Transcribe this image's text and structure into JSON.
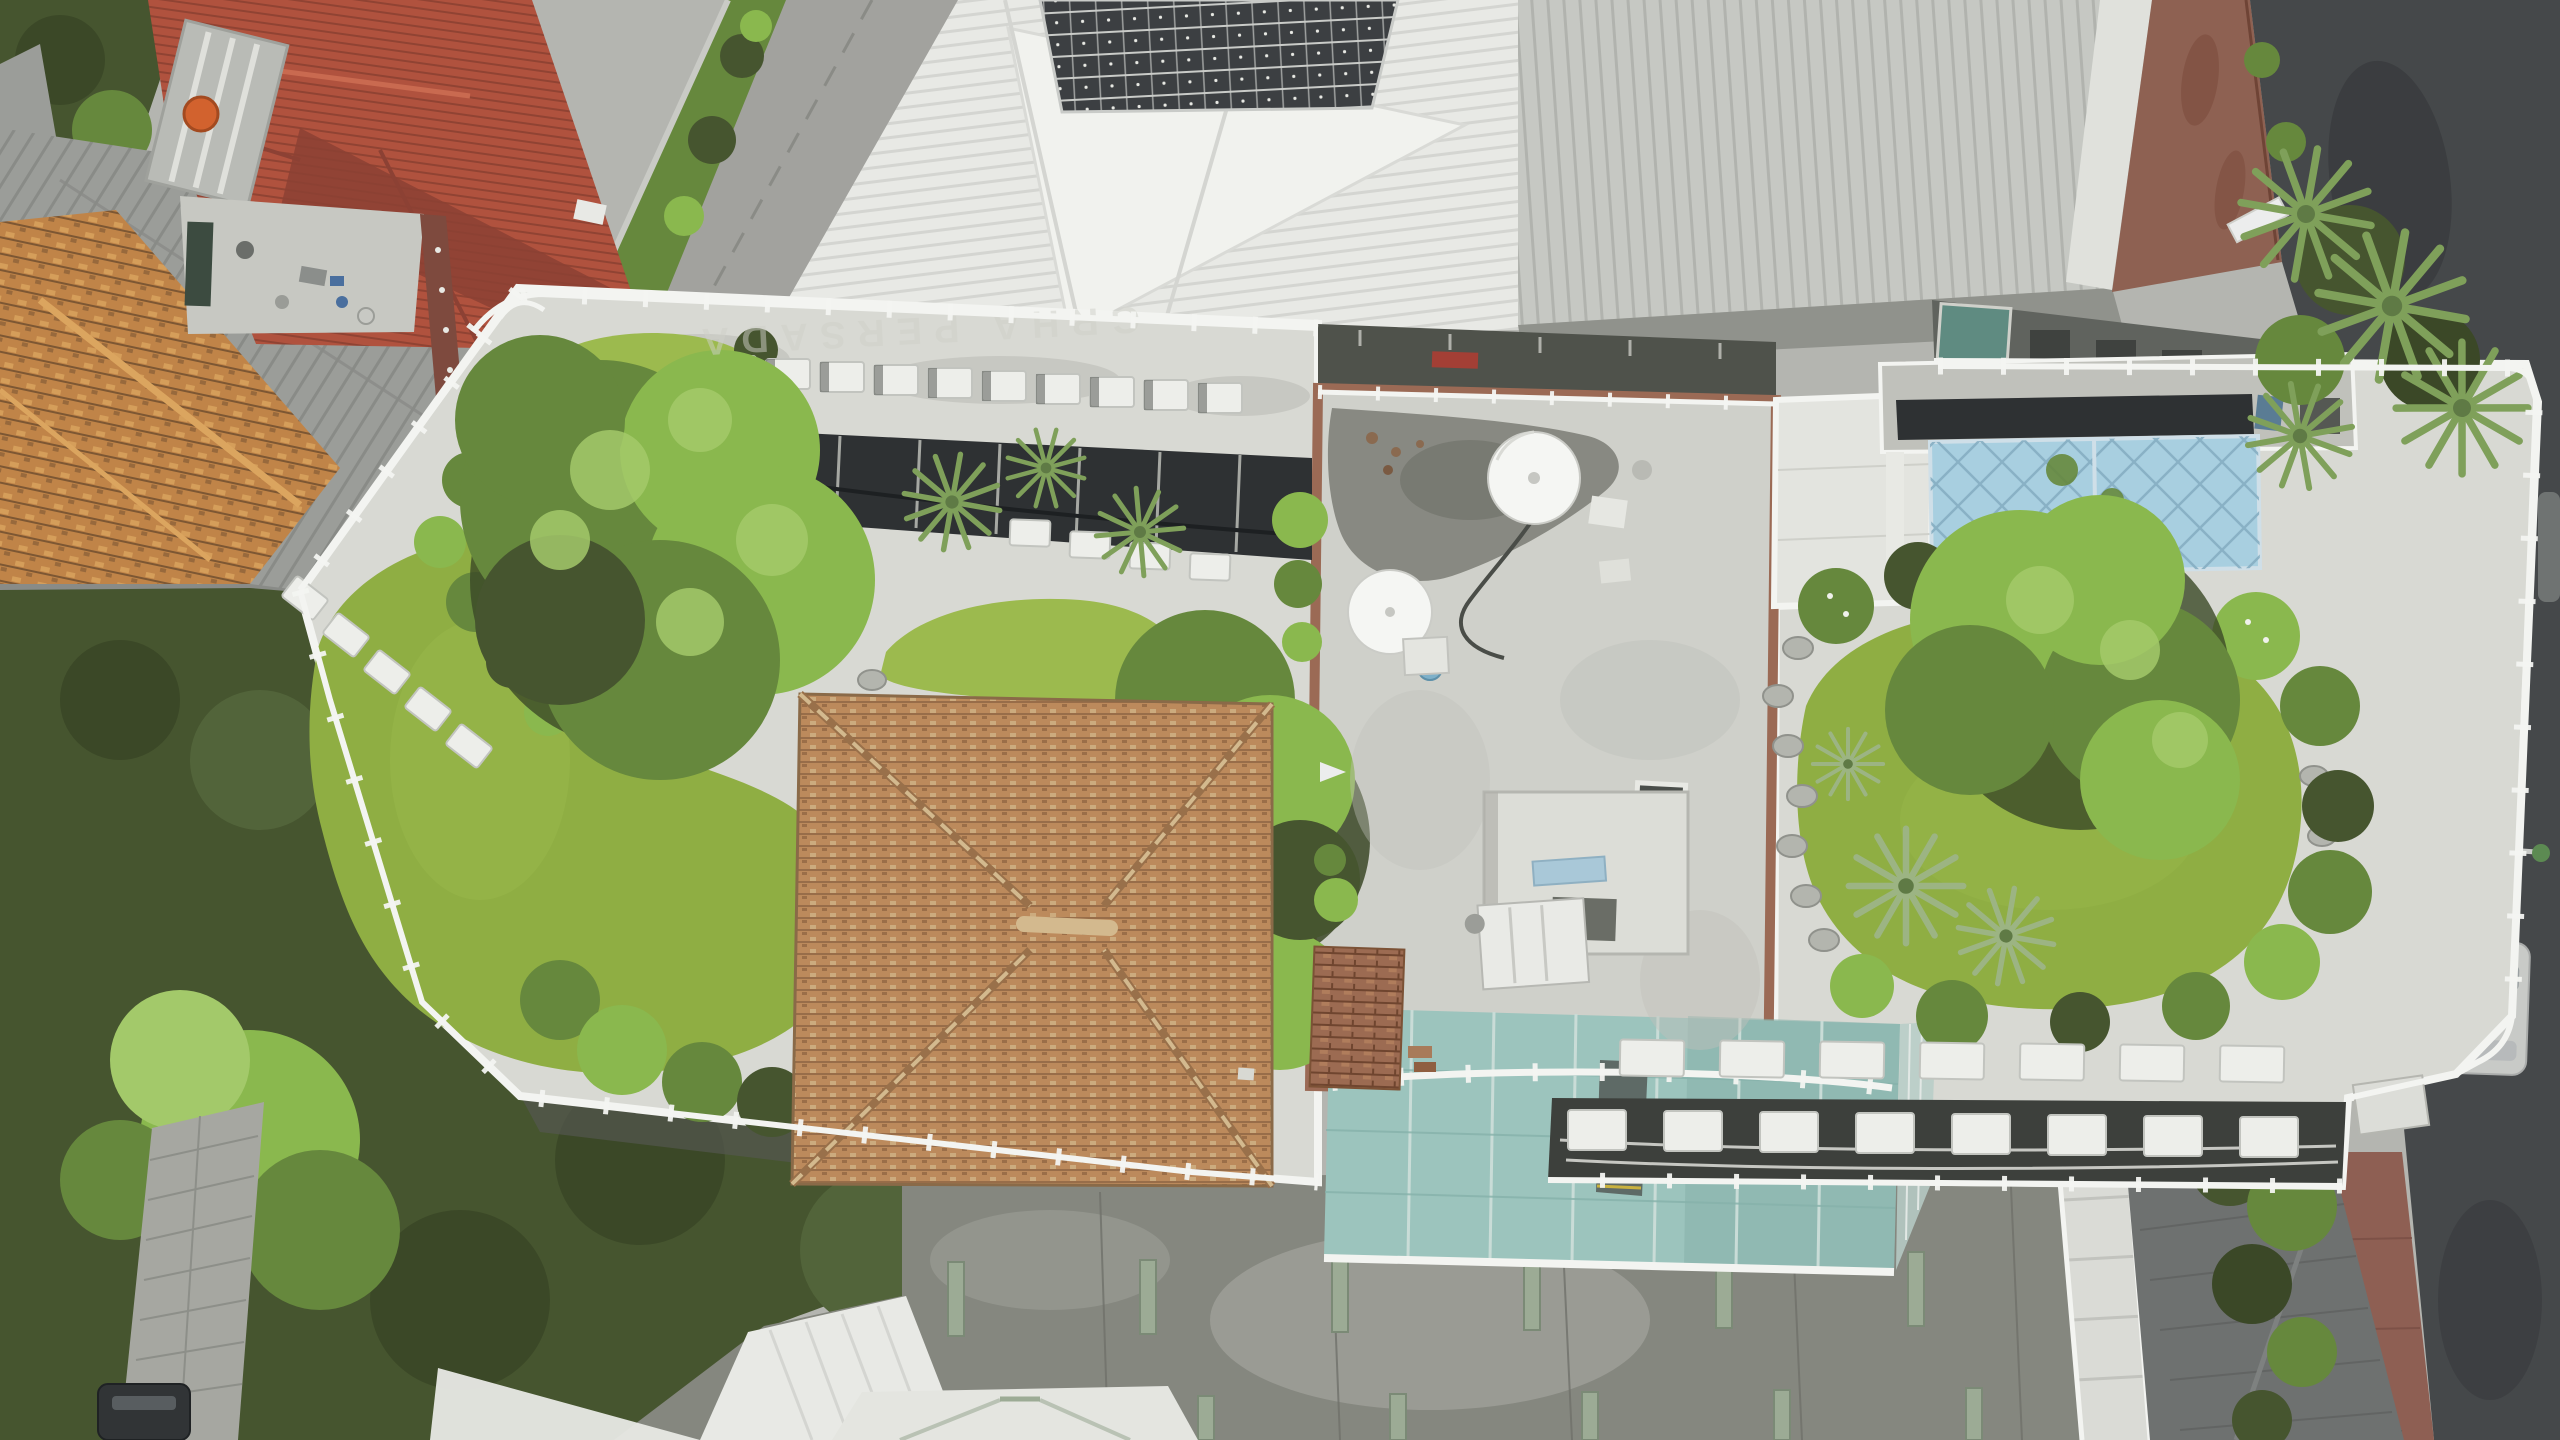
{
  "meta": {
    "title": "Aerial drone photograph, top-down view of an urban rooftop garden complex",
    "type": "aerial-photograph",
    "location_hint": "dense tropical city block"
  },
  "signage": {
    "parapet_text": "GRHA PERSADA"
  },
  "palette": {
    "bg": "#b4b5b0",
    "street_top": "#a2a29e",
    "street_asphalt": "#45484a",
    "street_wet": "#383b3d",
    "sidewalk_rust": "#8e6152",
    "sidewalk_red": "#8e5f53",
    "paver": "#a6a7a1",
    "paver_line": "#8d8f89",
    "veg_dark": "#46552f",
    "veg_dark2": "#3b4827",
    "veg_mid": "#66883d",
    "veg_bright": "#8ab84e",
    "veg_light": "#a3c96a",
    "palm_green": "#7fa05a",
    "palm_pale": "#9cb483",
    "lawn": "#8fae43",
    "lawn_light": "#9cba4e",
    "roof_white": "#e8e9e5",
    "roof_white_rib": "#d4d5d1",
    "roof_gray": "#c6c8c3",
    "roof_gray_rib": "#b1b3ae",
    "roof_gray_left": "#9b9d99",
    "roof_gray_left_dark": "#898b87",
    "solar": "#3c3f42",
    "solar_line": "#c9cbc8",
    "roof_red": "#b0523e",
    "roof_red_dark": "#8c4134",
    "clay": "#c08448",
    "clay_light": "#dba55f",
    "clay_dark": "#7d5733",
    "terrace": "#c7c8c2",
    "tank_orange": "#d2622e",
    "concrete": "#d8d9d3",
    "concrete_mottle": "#c0c1bb",
    "old_roof": "#cfd0ca",
    "wet_patch": "#84857d",
    "brick": "#9b6a55",
    "dish": "#f5f6f3",
    "teal": "#9cc4bd",
    "teal_dark": "#86b1aa",
    "teal_line": "#c9dcd7",
    "railing": "#f3f4f1",
    "ac": "#edeeea",
    "ac_dark": "#c2c4bf",
    "shade": "#2e3133",
    "deck": "#85877f",
    "deck_light": "#a8a9a2",
    "deck_line": "#6f716a",
    "beam": "#9cab95",
    "beam_dark": "#7b8a76",
    "tile_dark_roof": "#6e7170",
    "tile_dark_line": "#5c5f5e",
    "glassrail": "#b7cdc7",
    "water_blue": "#a8cfe0",
    "water_blue_line": "#86aec2",
    "car_red": "#a8403f",
    "car_silver": "#c8cac7",
    "car_dark": "#313436",
    "white_soft": "#e4e5e0",
    "shadow": "#545750",
    "banner": "#eceded",
    "bollard": "#c9a23f",
    "hip_base": "#bc8a5c",
    "hip_dark": "#8f6544",
    "hip_ridge": "#d3b98e"
  },
  "scene": {
    "regions": [
      {
        "name": "red-roof-house",
        "desc": "red clay-tile hip roof house, top-left, with gray metal skylight section",
        "color": "roof_red"
      },
      {
        "name": "orange-water-tank",
        "desc": "round orange water tank on red house roof",
        "color": "tank_orange"
      },
      {
        "name": "house-terrace",
        "desc": "cluttered gray service terrace of red house",
        "color": "terrace"
      },
      {
        "name": "clay-tile-roof",
        "desc": "weathered orange clay tile roof, lower left",
        "color": "clay"
      },
      {
        "name": "gray-metal-roofs-left",
        "desc": "old gray corrugated roofs along left edge",
        "color": "roof_gray_left"
      },
      {
        "name": "access-street-top",
        "desc": "concrete side street running diagonally at top with motorcycle and red car",
        "color": "street_top"
      },
      {
        "name": "white-metal-roofs",
        "desc": "white corrugated roofs, top center",
        "color": "roof_white"
      },
      {
        "name": "solar-panel-array",
        "desc": "dark rooftop solar panel array, top center-right",
        "color": "solar"
      },
      {
        "name": "warehouse-roof",
        "desc": "large pale gray ribbed warehouse roof, top right",
        "color": "roof_gray"
      },
      {
        "name": "rust-walkway",
        "desc": "rust stained walkway strip beside warehouse",
        "color": "sidewalk_rust"
      },
      {
        "name": "asphalt-street-right",
        "desc": "dark asphalt street along right edge with lamp, banner, cars",
        "color": "street_asphalt"
      },
      {
        "name": "rooftop-garden-left",
        "desc": "main rooftop garden, west wing: lawns, large trees, putting greens",
        "color": "concrete"
      },
      {
        "name": "main-lawn",
        "desc": "large organic artificial lawn, west wing",
        "color": "lawn"
      },
      {
        "name": "upper-putting-green",
        "desc": "small oval green below north railing",
        "color": "lawn_light"
      },
      {
        "name": "middle-putting-green",
        "desc": "kidney shaped green under fan palms",
        "color": "lawn_light"
      },
      {
        "name": "large-garden-tree",
        "desc": "large bright tree canopy over west lawn",
        "color": "veg_bright"
      },
      {
        "name": "fan-palms",
        "desc": "fan palm rosettes in planting beds",
        "color": "palm_green"
      },
      {
        "name": "ac-row-north",
        "desc": "row of white air-conditioner condensers along north parapet",
        "color": "ac"
      },
      {
        "name": "shade-cloth",
        "desc": "black shade-cloth planting strip behind AC row",
        "color": "shade"
      },
      {
        "name": "terracotta-hip-roof",
        "desc": "terracotta shingle hip roof pavilion with X ridges",
        "color": "hip_base"
      },
      {
        "name": "central-old-rooftop",
        "desc": "white weathered concrete rooftop with brick parapet",
        "color": "old_roof"
      },
      {
        "name": "satellite-dish-large",
        "desc": "large white satellite dish",
        "color": "dish"
      },
      {
        "name": "satellite-dish-small",
        "desc": "second white satellite dish",
        "color": "dish"
      },
      {
        "name": "tile-stacks",
        "desc": "stacked salvaged roof tiles on central rooftop",
        "color": "brick"
      },
      {
        "name": "rooftop-equipment",
        "desc": "white rooftop machine and recessed service notch",
        "color": "white_soft"
      },
      {
        "name": "right-garden",
        "desc": "east wing rooftop garden: lawn, stepping stones, palms",
        "color": "concrete"
      },
      {
        "name": "blue-water-tank",
        "desc": "light blue paneled water tank bank",
        "color": "water_blue"
      },
      {
        "name": "right-lawn",
        "desc": "kidney shaped east lawn with golf ball",
        "color": "lawn"
      },
      {
        "name": "stepping-stones",
        "desc": "natural stone steppers around east lawn",
        "color": "concrete_mottle"
      },
      {
        "name": "ac-rows-south",
        "desc": "double row of AC condensers on south parapet, east wing",
        "color": "ac"
      },
      {
        "name": "teal-glass-canopy",
        "desc": "teal glass atrium canopy with metal grid and railing",
        "color": "teal"
      },
      {
        "name": "perimeter-railing",
        "desc": "continuous white pipe guard railing around rooftop",
        "color": "railing"
      },
      {
        "name": "parking-deck",
        "desc": "weathered lower concrete deck, bottom, with pale green beams",
        "color": "deck"
      },
      {
        "name": "dark-tile-roof",
        "desc": "dark gray tiled lower roof, bottom right",
        "color": "tile_dark_roof"
      },
      {
        "name": "paver-path",
        "desc": "paved alley, bottom left, with parked dark car",
        "color": "paver"
      },
      {
        "name": "tree-mass",
        "desc": "dense dark street trees, bottom left",
        "color": "veg_dark"
      },
      {
        "name": "street-lamp",
        "desc": "lamp arm over right street",
        "color": "solar_line"
      },
      {
        "name": "silver-car",
        "desc": "silver car parked on right street",
        "color": "car_silver"
      },
      {
        "name": "red-car",
        "desc": "red car on top street",
        "color": "car_red"
      },
      {
        "name": "motorcycle",
        "desc": "motorcycle riding on top street",
        "color": "car_dark"
      },
      {
        "name": "white-banner",
        "desc": "fallen white banner on right sidewalk",
        "color": "banner"
      },
      {
        "name": "bollards",
        "desc": "yellow bollards on bottom-right sidewalk",
        "color": "bollard"
      }
    ]
  }
}
